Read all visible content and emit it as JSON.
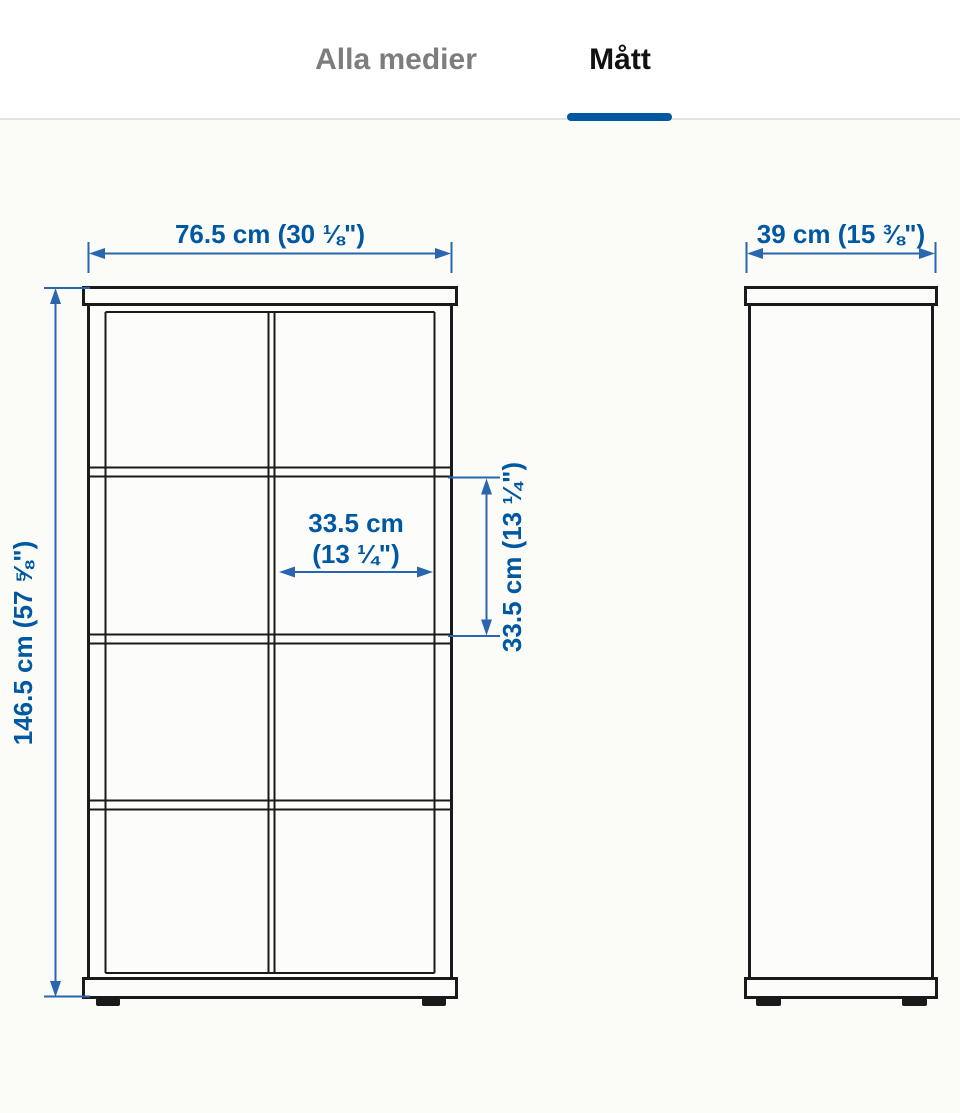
{
  "tabs": {
    "all_media": {
      "label": "Alla medier",
      "active": false
    },
    "dimensions": {
      "label": "Mått",
      "active": true
    }
  },
  "colors": {
    "accent_blue": "#0058a3",
    "dimension_line_blue": "#2a66ad",
    "drawing_line_black": "#1a1a1a",
    "inactive_tab_gray": "#7d7d7d",
    "active_tab_black": "#111111",
    "canvas_background": "#fbfbf8"
  },
  "diagram": {
    "front_view": {
      "width_label": "76.5 cm (30 ⅛\")",
      "height_label": "146.5 cm (57 ⅝\")",
      "inner_width_label_line1": "33.5 cm",
      "inner_width_label_line2": "(13 ¼\")",
      "inner_height_label": "33.5 cm (13 ¼\")",
      "grid_columns": 2,
      "grid_rows": 4
    },
    "side_view": {
      "depth_label": "39 cm (15 ⅜\")"
    }
  }
}
